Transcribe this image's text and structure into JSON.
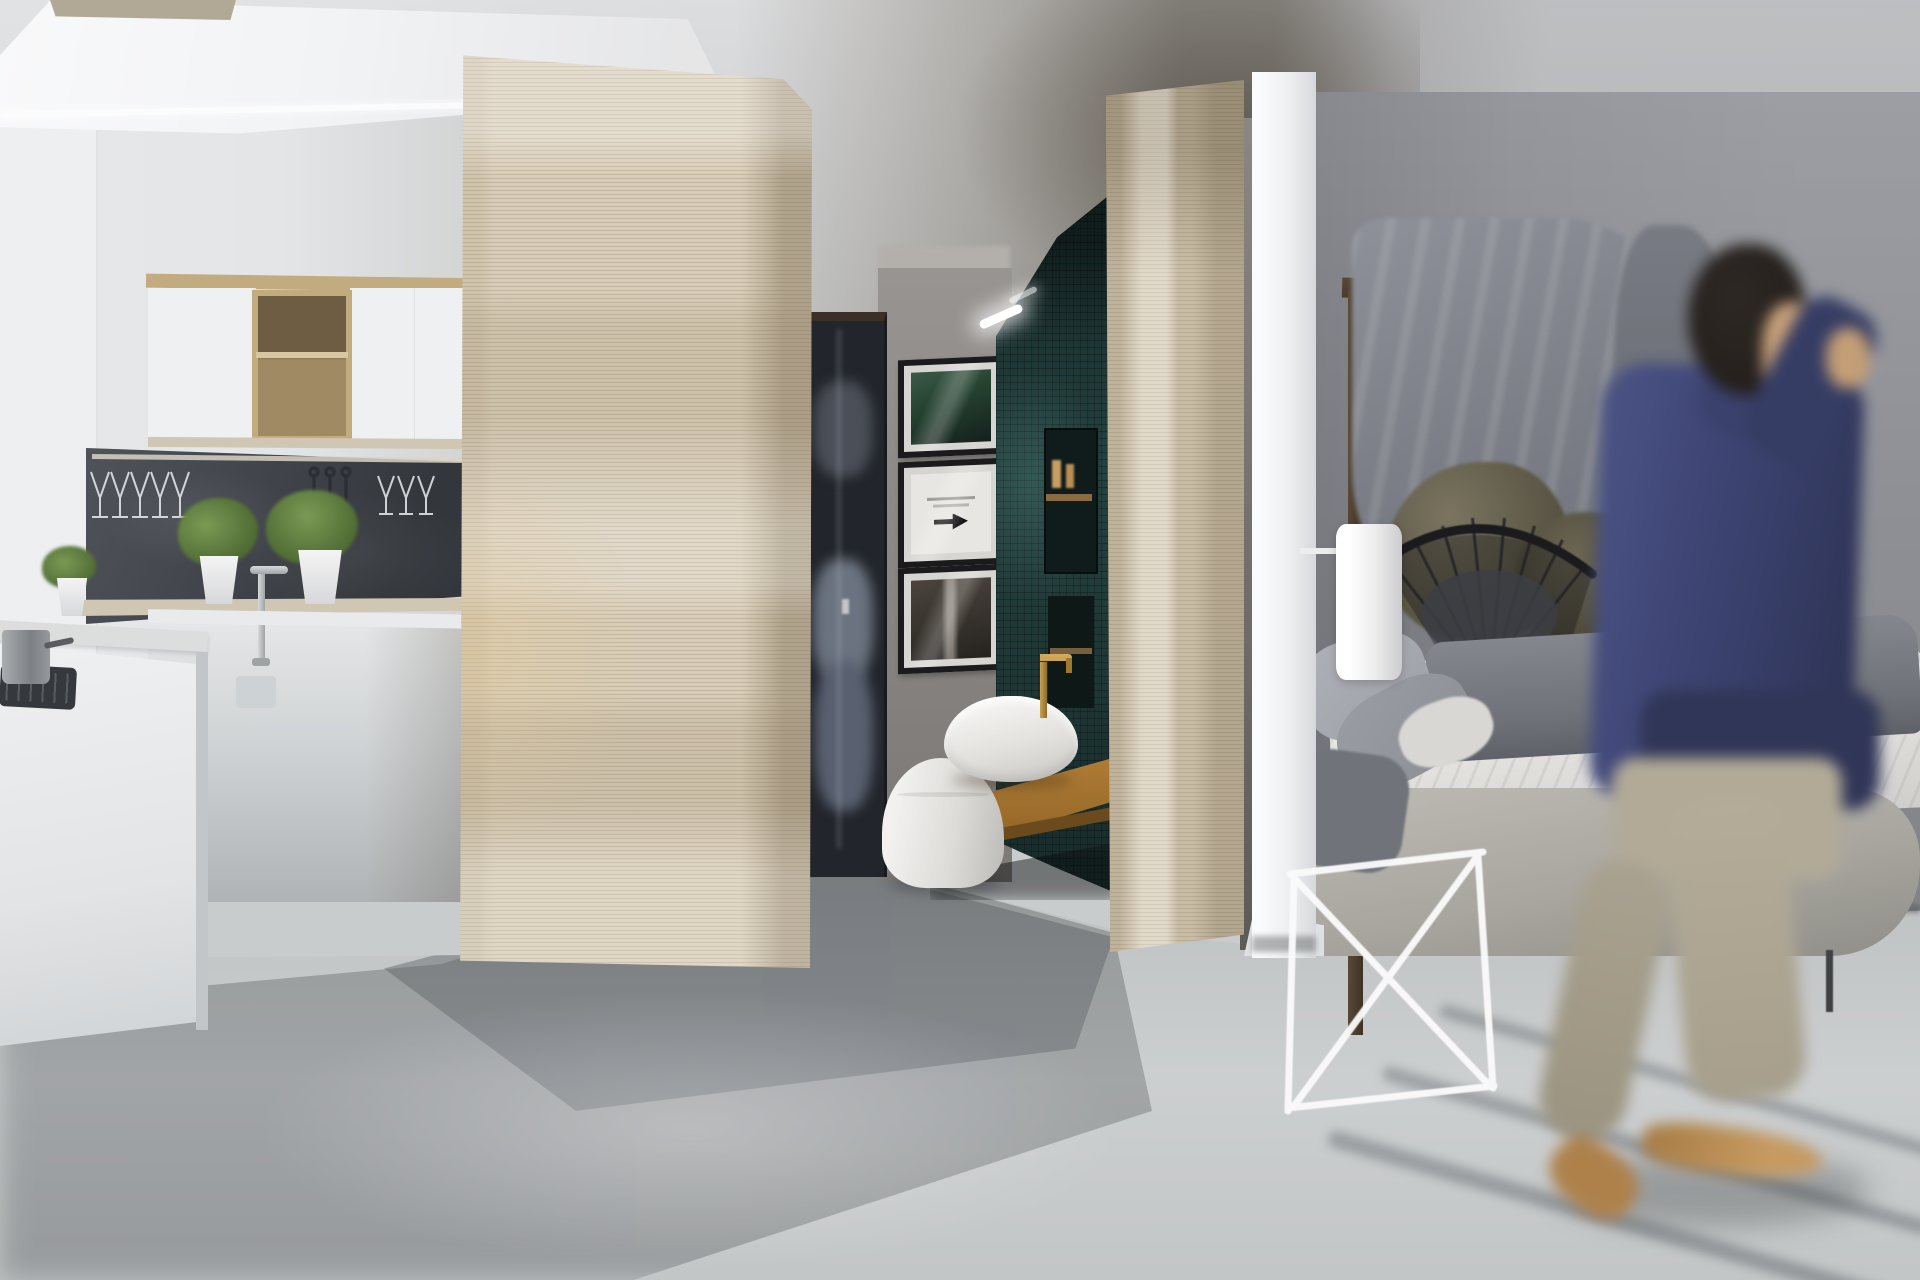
{
  "scene": {
    "title": "Modern studio apartment interior 3D render",
    "description": "Open-plan studio with white kitchen on the left, travertine wood partition walls dividing a teal-tiled bathroom nook in the center, a bedroom with canopy frame and rock decor on the right, and a motion-blurred man in a navy jacket walking across the foreground on a light concrete floor.",
    "regions": {
      "kitchen": "White upper cabinets with open oak cube shelf, dark slate backsplash with hanging wine glasses, pass-through ledge with potted plants, chrome faucet, white island with gas hob and steel pot",
      "bathroom_nook": "Gallery of three black framed prints, dark mirror door reflecting bedding, teal mosaic tile wall with LED cove light and recessed shelves, floating oak counter with white vessel sink, brass faucet and white toilet",
      "bedroom": "Dark wood canopy beam and post, gray drape curtain, mossy boulders, black wire papasan chair, white cylinder wall sconce, bed with white sheets, gray blanket and pillows, upholstered platform, white wire bench, small glowing lantern",
      "foreground": "Motion-blurred man holding a phone to his ear, navy jacket, beige trousers, tan shoes"
    },
    "objects": [
      {
        "name": "skylight",
        "desc": "beige skylight strip top-left"
      },
      {
        "name": "bulkhead",
        "desc": "white angled ceiling bulkhead"
      },
      {
        "name": "upper-cabinets",
        "desc": "white doors with oak open cube"
      },
      {
        "name": "wine-glass-rack",
        "desc": "stemware hanging under rail on slate"
      },
      {
        "name": "plants",
        "desc": "three green plants in white pots"
      },
      {
        "name": "island",
        "desc": "white kitchen island with hob and pot"
      },
      {
        "name": "partition-travertine-1",
        "desc": "large striated wood partition"
      },
      {
        "name": "mirror-door",
        "desc": "dark door reflecting blue-gray bedding"
      },
      {
        "name": "framed-prints",
        "desc": "three stacked black frames, middle with arrow artwork"
      },
      {
        "name": "teal-tile-wall",
        "desc": "dark teal mosaic with LED glow and niches"
      },
      {
        "name": "vessel-sink",
        "desc": "white bowl on oak counter with brass tap"
      },
      {
        "name": "toilet",
        "desc": "white toilet seen from behind"
      },
      {
        "name": "partition-travertine-2",
        "desc": "second striated wood partition"
      },
      {
        "name": "white-column",
        "desc": "white structural column"
      },
      {
        "name": "canopy-frame",
        "desc": "dark wood beam and post"
      },
      {
        "name": "wire-chair",
        "desc": "black radial wire papasan chair"
      },
      {
        "name": "wall-sconce",
        "desc": "white cylinder lamp on arm"
      },
      {
        "name": "bed",
        "desc": "white sheets, gray blanket, gray pillows, fabric platform"
      },
      {
        "name": "wire-bench",
        "desc": "white wire bench at bed foot"
      },
      {
        "name": "glow-lantern",
        "desc": "small warm glowing box beside chair"
      },
      {
        "name": "walking-person",
        "desc": "blurred man on phone walking right to left"
      }
    ]
  },
  "palette": {
    "ceiling": "#d8d9db",
    "kitchen_wall": "#e3e5e7",
    "left_panel": "#edeff0",
    "bulkhead": "#f2f3f5",
    "edge_light": "#fdfdfe",
    "skylight": "#b2a896",
    "cabinet_white": "#eef0f2",
    "cabinet_wood_frame": "#c3ab80",
    "cabinet_wood_interior": "#a08a63",
    "cabinet_wood_dark": "#6e5d42",
    "cabinet_wood_shelf": "#d8c7a2",
    "slate_backsplash": "#41454c",
    "glass_rail": "#d9d3c4",
    "ledge": "#cfc7b3",
    "plant_green": "#4e6b33",
    "plant_green_light": "#7a9a55",
    "pot_white": "#f4f4f4",
    "chrome": "#9fa3a6",
    "counter_white": "#e9eaeb",
    "island_white": "#eef0f1",
    "island_top": "#dcdedd",
    "hob_black": "#35383c",
    "pot_steel": "#7d8084",
    "partition_wood": "#d8cdb8",
    "partition_wood_2": "#d2c7b1",
    "nook_wall": "#8f8b88",
    "nook_ceiling": "#b3afab",
    "mirror_dark": "#22252b",
    "mirror_frame_top": "#3a3027",
    "bedding_blue": "#6b7380",
    "frame_border": "#1b1b1d",
    "frame_mat": "#d7d5d1",
    "art_green": "#24402f",
    "art_light": "#e8e6e2",
    "art_dark": "#26231f",
    "tile_teal": "#24413f",
    "led_white": "#ffffff",
    "niche_dark": "#101b1b",
    "niche_shelf_wood": "#8a6a41",
    "counter_oak": "#b07c35",
    "counter_oak_edge": "#6b4b1d",
    "sink_white": "#f7f6f4",
    "brass": "#caa254",
    "toilet_white": "#f2f1ef",
    "column_white": "#fafbfc",
    "bedroom_wall": "#8b8d93",
    "beam_wood": "#4b3b2c",
    "post_wood": "#3e3225",
    "curtain": "#7d8088",
    "curtain_fold": "#787b83",
    "boulder": "#5d5847",
    "boulder2": "#6b6552",
    "chair_wire": "#232326",
    "chair_cushion": "#3c3e44",
    "sconce": "#ffffff",
    "sconce_arm": "#eceded",
    "glow_body": "#221d16",
    "glow_warm": "#e3ae4e",
    "pillow1": "#9da0a6",
    "pillow2": "#8b8e94",
    "pillow_light": "#d8d7d4",
    "sheet": "#efeeec",
    "blanket": "#6e7177",
    "throw": "#70737a",
    "bed_frame": "#bcbab3",
    "bed_leg": "#3f4143",
    "bench_white": "#fafafa",
    "floor": "#c9cccd",
    "floor_shadow": "#787c7f",
    "streak_shadow": "#686d72",
    "hair": "#241f1c",
    "skin": "#c9a077",
    "jacket": "#3c4373",
    "jacket_dark": "#303659",
    "pants": "#b2aa96",
    "shoe": "#c89a5d",
    "glass_stroke": "#e4e8eb",
    "utensil_dark": "#2b2e33"
  }
}
